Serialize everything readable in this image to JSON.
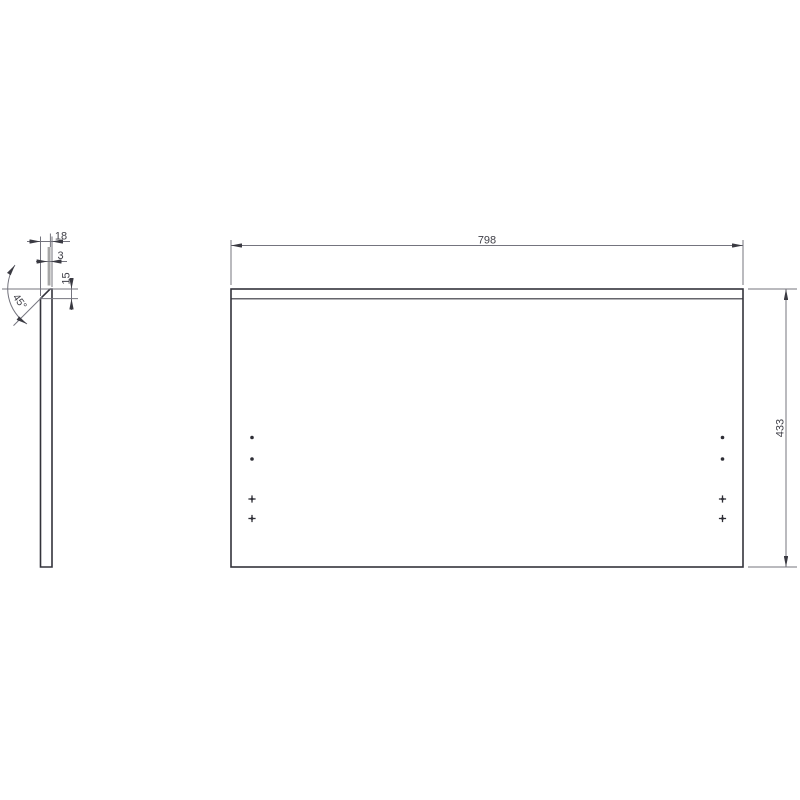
{
  "drawing": {
    "front_view": {
      "width_dim": "798",
      "height_dim": "433"
    },
    "side_view": {
      "thickness_dim": "18",
      "top_face_dim": "3",
      "chamfer_depth_dim": "15",
      "chamfer_angle_dim": "45°"
    },
    "colors": {
      "outline": "#33333b",
      "dimension_line": "#74747e",
      "edge_strip_gray": "#a6a6a6",
      "text": "#3f3f47",
      "background": "#ffffff"
    }
  }
}
